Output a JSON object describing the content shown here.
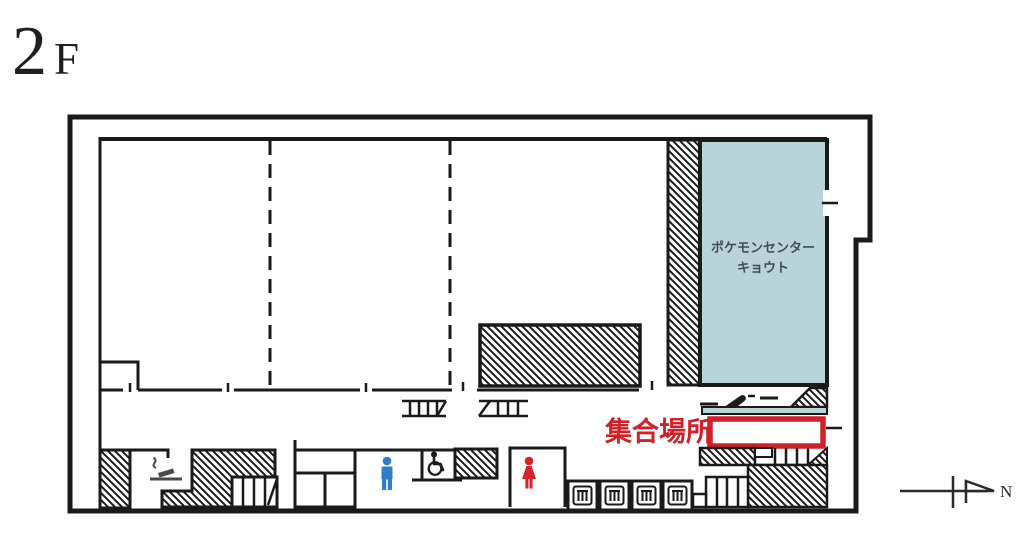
{
  "header": {
    "floor_number": "2",
    "floor_suffix": "F"
  },
  "plan": {
    "store": {
      "name_line1": "ポケモンセンター",
      "name_line2": "キョウト",
      "fill": "#b7d4d8",
      "text_color": "#3f4e55"
    },
    "meeting_point": {
      "label": "集合場所",
      "accent": "#cf2127"
    },
    "compass": {
      "north_label": "N"
    },
    "colors": {
      "wall": "#1a1a1a",
      "mens_restroom_icon": "#2f7dc8",
      "womens_restroom_icon": "#d5232b",
      "escalator_icon": "#1a1a1a",
      "smoking_icon": "#4a4a4a"
    }
  }
}
